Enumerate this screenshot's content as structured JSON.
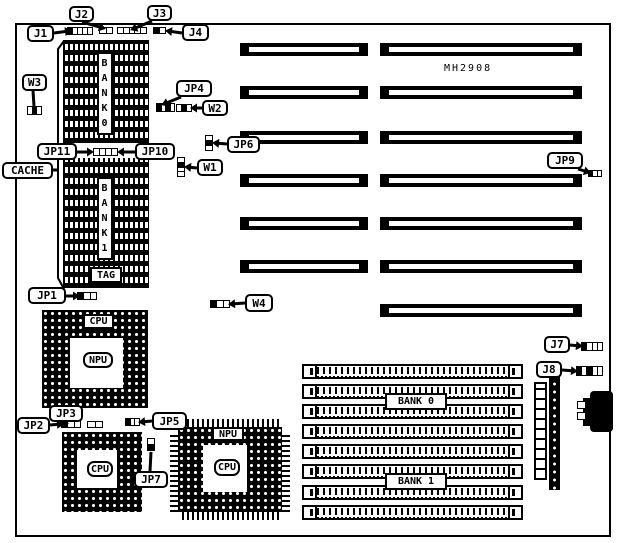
{
  "diagram": {
    "board_label": "MH2908",
    "labels": {
      "cache": "CACHE",
      "tag": "TAG",
      "bank0_vertical": "BANK0",
      "bank1_vertical": "BANK1",
      "simm_bank0": "BANK 0",
      "simm_bank1": "BANK 1",
      "cpu": "CPU",
      "npu": "NPU"
    },
    "callouts": [
      {
        "id": "j1",
        "label": "J1",
        "box": [
          27,
          25,
          27,
          17
        ],
        "tail": [
          [
            54,
            33
          ],
          [
            69,
            31
          ]
        ],
        "arrow": true
      },
      {
        "id": "j2",
        "label": "J2",
        "box": [
          69,
          6,
          25,
          16
        ],
        "tail": [
          [
            82,
            22
          ],
          [
            103,
            28
          ]
        ],
        "arrow": true
      },
      {
        "id": "j3",
        "label": "J3",
        "box": [
          147,
          5,
          25,
          16
        ],
        "tail": [
          [
            152,
            21
          ],
          [
            133,
            29
          ]
        ],
        "arrow": true
      },
      {
        "id": "j4",
        "label": "J4",
        "box": [
          182,
          24,
          27,
          17
        ],
        "tail": [
          [
            182,
            33
          ],
          [
            168,
            31
          ]
        ],
        "arrow": true
      },
      {
        "id": "w3",
        "label": "W3",
        "box": [
          22,
          74,
          25,
          17
        ],
        "tail": [
          [
            33,
            91
          ],
          [
            34,
            106
          ]
        ],
        "arrow": false
      },
      {
        "id": "jp4",
        "label": "JP4",
        "box": [
          176,
          80,
          36,
          17
        ],
        "tail": [
          [
            181,
            97
          ],
          [
            164,
            104
          ]
        ],
        "arrow": true
      },
      {
        "id": "w2",
        "label": "W2",
        "box": [
          202,
          100,
          26,
          16
        ],
        "tail": [
          [
            202,
            108
          ],
          [
            193,
            108
          ]
        ],
        "arrow": true
      },
      {
        "id": "jp6",
        "label": "JP6",
        "box": [
          227,
          136,
          33,
          17
        ],
        "tail": [
          [
            227,
            144
          ],
          [
            215,
            143
          ]
        ],
        "arrow": true
      },
      {
        "id": "w1",
        "label": "W1",
        "box": [
          197,
          159,
          26,
          17
        ],
        "tail": [
          [
            197,
            168
          ],
          [
            187,
            167
          ]
        ],
        "arrow": true
      },
      {
        "id": "jp11",
        "label": "JP11",
        "box": [
          37,
          143,
          40,
          17
        ],
        "tail": [
          [
            77,
            152
          ],
          [
            91,
            152
          ]
        ],
        "arrow": true
      },
      {
        "id": "jp10",
        "label": "JP10",
        "box": [
          135,
          143,
          40,
          17
        ],
        "tail": [
          [
            135,
            152
          ],
          [
            120,
            152
          ]
        ],
        "arrow": true
      },
      {
        "id": "cache",
        "label": "CACHE",
        "box": [
          2,
          162,
          51,
          17
        ],
        "tail": [
          [
            53,
            170
          ],
          [
            59,
            170
          ]
        ],
        "arrow": false
      },
      {
        "id": "jp1",
        "label": "JP1",
        "box": [
          28,
          287,
          38,
          17
        ],
        "tail": [
          [
            66,
            296
          ],
          [
            77,
            296
          ]
        ],
        "arrow": true
      },
      {
        "id": "w4",
        "label": "W4",
        "box": [
          245,
          294,
          28,
          18
        ],
        "tail": [
          [
            245,
            303
          ],
          [
            231,
            304
          ]
        ],
        "arrow": true
      },
      {
        "id": "jp9",
        "label": "JP9",
        "box": [
          547,
          152,
          36,
          17
        ],
        "tail": [
          [
            578,
            169
          ],
          [
            588,
            172
          ]
        ],
        "arrow": true
      },
      {
        "id": "jp2",
        "label": "JP2",
        "box": [
          17,
          417,
          33,
          17
        ],
        "tail": [
          [
            50,
            425
          ],
          [
            61,
            424
          ]
        ],
        "arrow": true
      },
      {
        "id": "jp3",
        "label": "JP3",
        "box": [
          49,
          405,
          34,
          17
        ],
        "tail": [
          [
            57,
            422
          ],
          [
            66,
            423
          ]
        ],
        "arrow": true
      },
      {
        "id": "jp5",
        "label": "JP5",
        "box": [
          152,
          412,
          35,
          18
        ],
        "tail": [
          [
            152,
            421
          ],
          [
            141,
            422
          ]
        ],
        "arrow": true
      },
      {
        "id": "jp7",
        "label": "JP7",
        "box": [
          134,
          471,
          34,
          17
        ],
        "tail": [
          [
            150,
            471
          ],
          [
            151,
            452
          ]
        ],
        "arrow": false
      },
      {
        "id": "j7",
        "label": "J7",
        "box": [
          544,
          336,
          26,
          17
        ],
        "tail": [
          [
            570,
            345
          ],
          [
            580,
            346
          ]
        ],
        "arrow": true
      },
      {
        "id": "j8",
        "label": "J8",
        "box": [
          536,
          361,
          26,
          17
        ],
        "tail": [
          [
            562,
            370
          ],
          [
            575,
            371
          ]
        ],
        "arrow": true
      }
    ],
    "jumpers": [
      {
        "id": "j1",
        "at": [
          67,
          27,
          26,
          8
        ],
        "dir": "h",
        "cells": "bwwww"
      },
      {
        "id": "j2",
        "at": [
          99,
          27,
          14,
          7
        ],
        "dir": "h",
        "cells": "ww"
      },
      {
        "id": "j3",
        "at": [
          117,
          27,
          30,
          7
        ],
        "dir": "h",
        "cells": "wwwww"
      },
      {
        "id": "j4",
        "at": [
          153,
          27,
          13,
          7
        ],
        "dir": "h",
        "cells": "bw"
      },
      {
        "id": "w3",
        "at": [
          27,
          106,
          15,
          9
        ],
        "dir": "h",
        "cells": "wbw"
      },
      {
        "id": "jp4",
        "at": [
          156,
          103,
          19,
          9
        ],
        "dir": "h",
        "cells": "bwbw"
      },
      {
        "id": "w2",
        "at": [
          176,
          104,
          16,
          8
        ],
        "dir": "h",
        "cells": "wbw"
      },
      {
        "id": "jp6",
        "at": [
          205,
          135,
          8,
          16
        ],
        "dir": "v",
        "cells": "wbw"
      },
      {
        "id": "w1",
        "at": [
          177,
          157,
          8,
          20
        ],
        "dir": "v",
        "cells": "wbww"
      },
      {
        "id": "jp10-11",
        "at": [
          93,
          148,
          25,
          8
        ],
        "dir": "h",
        "cells": "wwww"
      },
      {
        "id": "jp1",
        "at": [
          77,
          292,
          20,
          8
        ],
        "dir": "h",
        "cells": "bww"
      },
      {
        "id": "w4",
        "at": [
          210,
          300,
          20,
          8
        ],
        "dir": "h",
        "cells": "bww"
      },
      {
        "id": "jp9",
        "at": [
          588,
          170,
          14,
          7
        ],
        "dir": "h",
        "cells": "bww"
      },
      {
        "id": "jp2-a",
        "at": [
          61,
          420,
          20,
          8
        ],
        "dir": "h",
        "cells": "bww"
      },
      {
        "id": "jp2-b",
        "at": [
          87,
          421,
          16,
          7
        ],
        "dir": "h",
        "cells": "ww"
      },
      {
        "id": "jp5",
        "at": [
          125,
          418,
          15,
          8
        ],
        "dir": "h",
        "cells": "bww"
      },
      {
        "id": "jp7",
        "at": [
          147,
          438,
          8,
          13
        ],
        "dir": "v",
        "cells": "wb"
      },
      {
        "id": "j7",
        "at": [
          581,
          342,
          22,
          9
        ],
        "dir": "h",
        "cells": "bwww"
      },
      {
        "id": "j8",
        "at": [
          576,
          366,
          27,
          10
        ],
        "dir": "h",
        "cells": "bwbww"
      }
    ],
    "isa_slots": [
      [
        240,
        43,
        128,
        13
      ],
      [
        240,
        86,
        128,
        13
      ],
      [
        240,
        131,
        128,
        13
      ],
      [
        240,
        174,
        128,
        13
      ],
      [
        240,
        217,
        128,
        13
      ],
      [
        240,
        260,
        128,
        13
      ],
      [
        380,
        43,
        202,
        13
      ],
      [
        380,
        86,
        202,
        13
      ],
      [
        380,
        131,
        202,
        13
      ],
      [
        380,
        174,
        202,
        13
      ],
      [
        380,
        217,
        202,
        13
      ],
      [
        380,
        260,
        202,
        13
      ],
      [
        380,
        304,
        202,
        13
      ]
    ],
    "simm_slots": [
      [
        302,
        364,
        221,
        15
      ],
      [
        302,
        384,
        221,
        15
      ],
      [
        302,
        404,
        221,
        15
      ],
      [
        302,
        424,
        221,
        15
      ],
      [
        302,
        444,
        221,
        15
      ],
      [
        302,
        464,
        221,
        15
      ],
      [
        302,
        485,
        221,
        15
      ],
      [
        302,
        505,
        221,
        15
      ]
    ],
    "cache_bracket": [
      [
        64,
        41
      ],
      [
        58,
        49
      ],
      [
        58,
        278
      ],
      [
        64,
        289
      ]
    ]
  }
}
